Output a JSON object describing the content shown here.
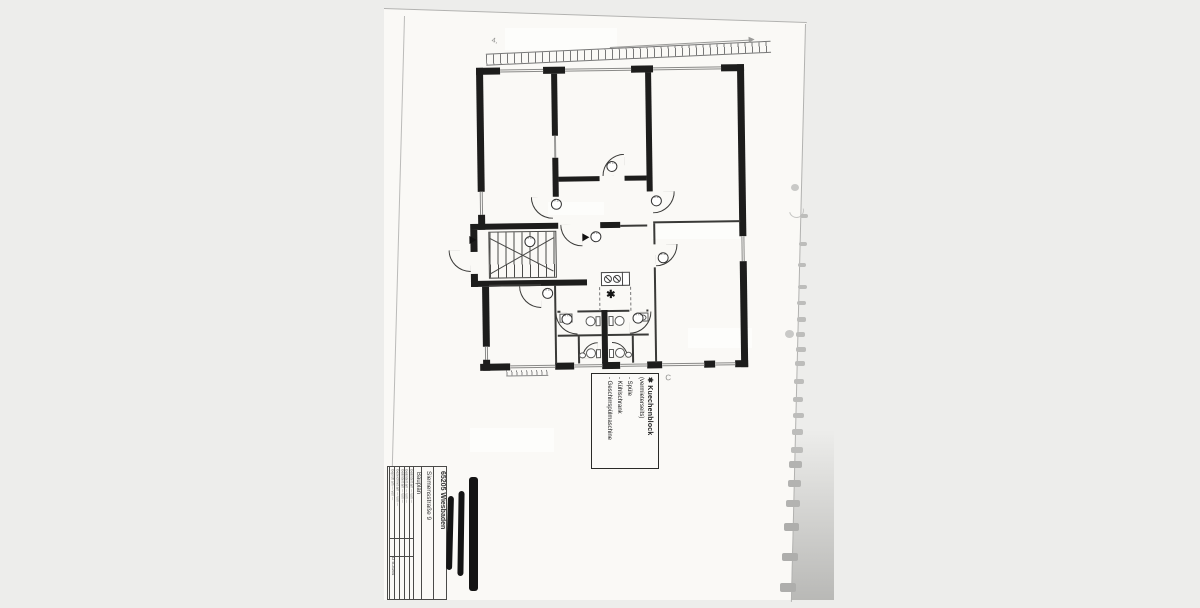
{
  "plan": {
    "door_tag_label": "88 198",
    "kitchen_symbol": "✱",
    "handwriting_top": "4,",
    "handwriting_c": "C"
  },
  "legend": {
    "symbol": "✱",
    "title": "Kuechenblock",
    "subtitle": "(vermieterseits)",
    "items": [
      "- Spüle",
      "- Kühlschrank",
      "- Geschirrspülmaschine"
    ]
  },
  "title_block": {
    "city": "65205 Wiesbaden",
    "street": "Siemensstraße 9",
    "doc_type": "Bauplan",
    "rows": [
      "Geändert am — von —",
      "Geändert am — von —",
      "Geändert am — von —",
      "Gezeichnet am — von —",
      "Geprüft am — von —"
    ],
    "drawing_no": "D 5.3164"
  },
  "colors": {
    "wall": "#1d1d1c",
    "page": "#faf9f6",
    "background": "#ededeb",
    "redaction": "#141414"
  }
}
